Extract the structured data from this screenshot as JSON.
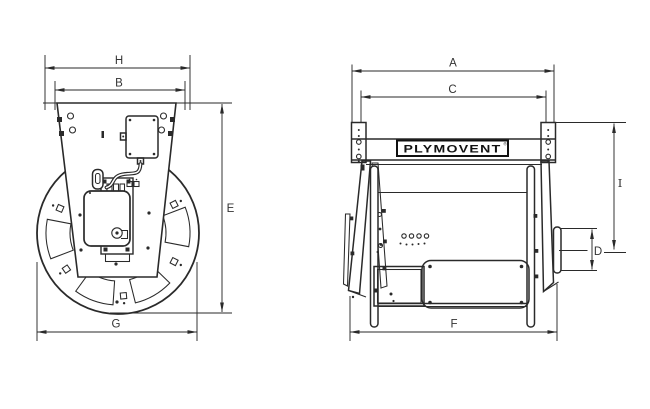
{
  "colors": {
    "ink": "#2a2a2a",
    "background": "#ffffff",
    "label_ink": "#333333",
    "logo_ink": "#111111"
  },
  "front_view": {
    "dim_labels": {
      "h": "H",
      "b": "B",
      "e": "E",
      "g": "G"
    }
  },
  "side_view": {
    "dim_labels": {
      "a": "A",
      "c": "C",
      "i": "I",
      "d": "D",
      "f": "F"
    },
    "logo": {
      "text": "PLYMOVENT",
      "mark": "®"
    }
  }
}
